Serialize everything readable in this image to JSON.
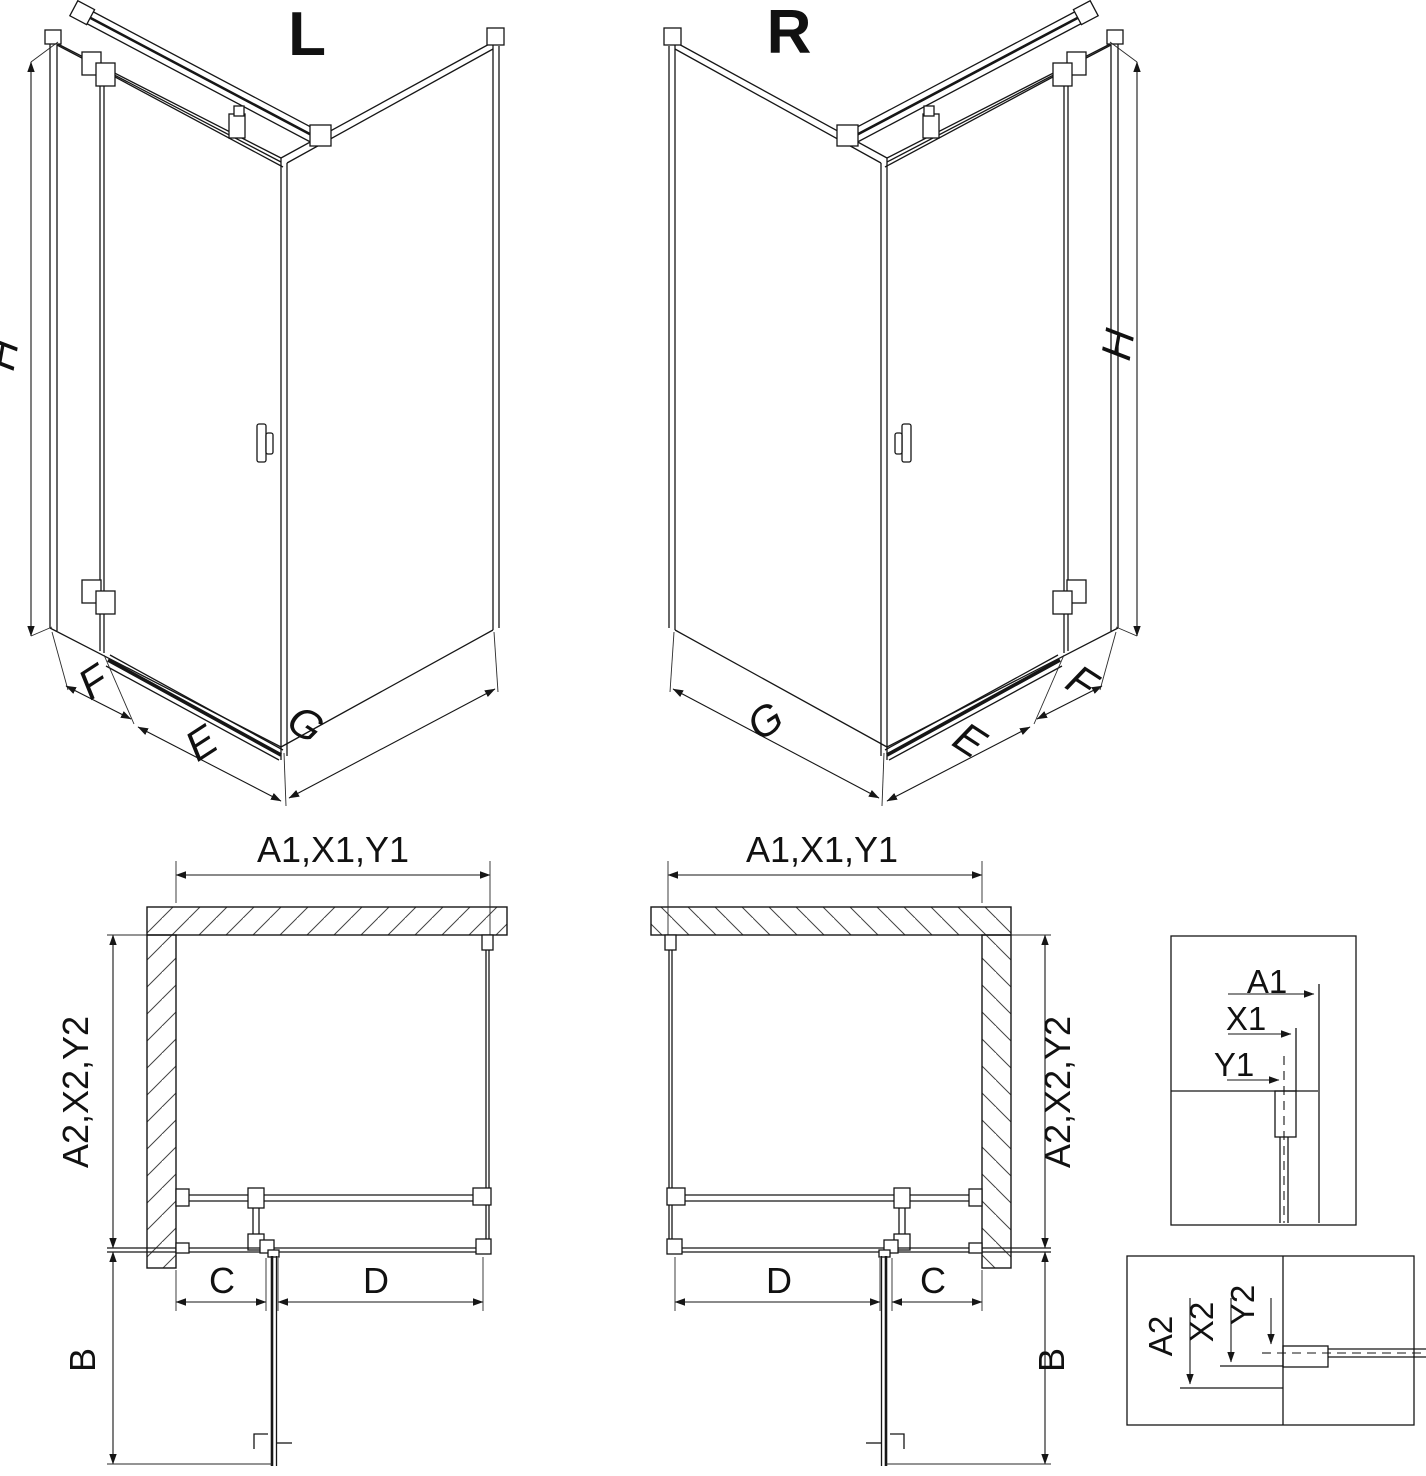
{
  "page": {
    "background": "#ffffff",
    "line_color": "#161616"
  },
  "iso_left": {
    "variant_label": "L",
    "height_label": "H",
    "return_label": "F",
    "door_label": "E",
    "wall_label": "G"
  },
  "iso_right": {
    "variant_label": "R",
    "height_label": "H",
    "return_label": "F",
    "door_label": "E",
    "wall_label": "G"
  },
  "plan_left": {
    "width_label": "A1,X1,Y1",
    "depth_label": "A2,X2,Y2",
    "swing_label": "B",
    "hinge_offset_label": "C",
    "opening_label": "D"
  },
  "plan_right": {
    "width_label": "A1,X1,Y1",
    "depth_label": "A2,X2,Y2",
    "swing_label": "B",
    "hinge_offset_label": "C",
    "opening_label": "D"
  },
  "detail_top": {
    "labels": [
      "A1",
      "X1",
      "Y1"
    ]
  },
  "detail_bottom": {
    "labels": [
      "A2",
      "X2",
      "Y2"
    ]
  }
}
